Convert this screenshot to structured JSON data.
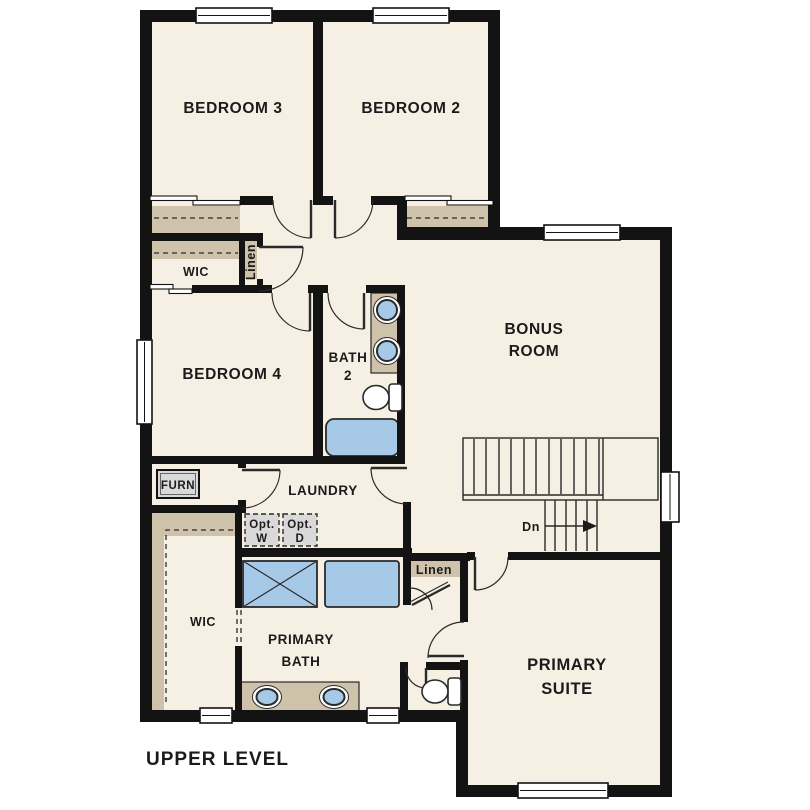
{
  "floorplan": {
    "title": "UPPER LEVEL",
    "colors": {
      "floor": "#f6efe3",
      "closet": "#cec2aa",
      "wall": "#131313",
      "line": "#2a2a2a",
      "fixture": "#a6c9e8",
      "gray": "#d9d9d9"
    },
    "labels": {
      "bedroom3": "BEDROOM 3",
      "bedroom2": "BEDROOM 2",
      "bedroom4": "BEDROOM 4",
      "bath2_line1": "BATH",
      "bath2_line2": "2",
      "bonus_line1": "BONUS",
      "bonus_line2": "ROOM",
      "laundry": "LAUNDRY",
      "primary_bath_line1": "PRIMARY",
      "primary_bath_line2": "BATH",
      "primary_suite_line1": "PRIMARY",
      "primary_suite_line2": "SUITE",
      "wic_hall": "WIC",
      "wic_primary": "WIC",
      "linen_hall": "Linen",
      "linen_primary": "Linen",
      "furnace": "FURN",
      "opt_washer_line1": "Opt.",
      "opt_washer_line2": "W",
      "opt_dryer_line1": "Opt.",
      "opt_dryer_line2": "D",
      "stairs_direction": "Dn"
    }
  }
}
